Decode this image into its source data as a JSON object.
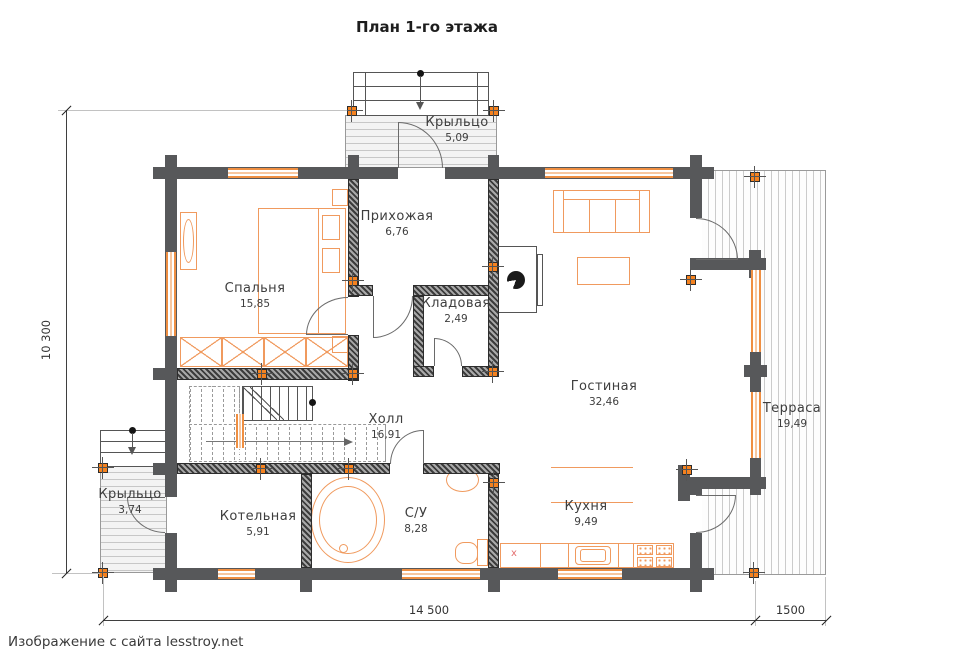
{
  "title": "План 1-го этажа",
  "footer": "Изображение с сайта lesstroy.net",
  "rooms": [
    {
      "name": "Крыльцо",
      "area": "5,09"
    },
    {
      "name": "Прихожая",
      "area": "6,76"
    },
    {
      "name": "Спальня",
      "area": "15,85"
    },
    {
      "name": "Кладовая",
      "area": "2,49"
    },
    {
      "name": "Гостиная",
      "area": "32,46"
    },
    {
      "name": "Терраса",
      "area": "19,49"
    },
    {
      "name": "Холл",
      "area": "16,91"
    },
    {
      "name": "С/У",
      "area": "8,28"
    },
    {
      "name": "Кухня",
      "area": "9,49"
    },
    {
      "name": "Котельная",
      "area": "5,91"
    },
    {
      "name": "Крыльцо",
      "area": "3,74"
    }
  ],
  "dimensions": {
    "height_total": "10 300",
    "width_main": "14 500",
    "width_terrace": "1500"
  },
  "marks": {
    "counter_x": "x"
  },
  "colors": {
    "wall": "#57585a",
    "accent_orange": "#f5821f",
    "furniture_orange": "#f09a5e"
  }
}
